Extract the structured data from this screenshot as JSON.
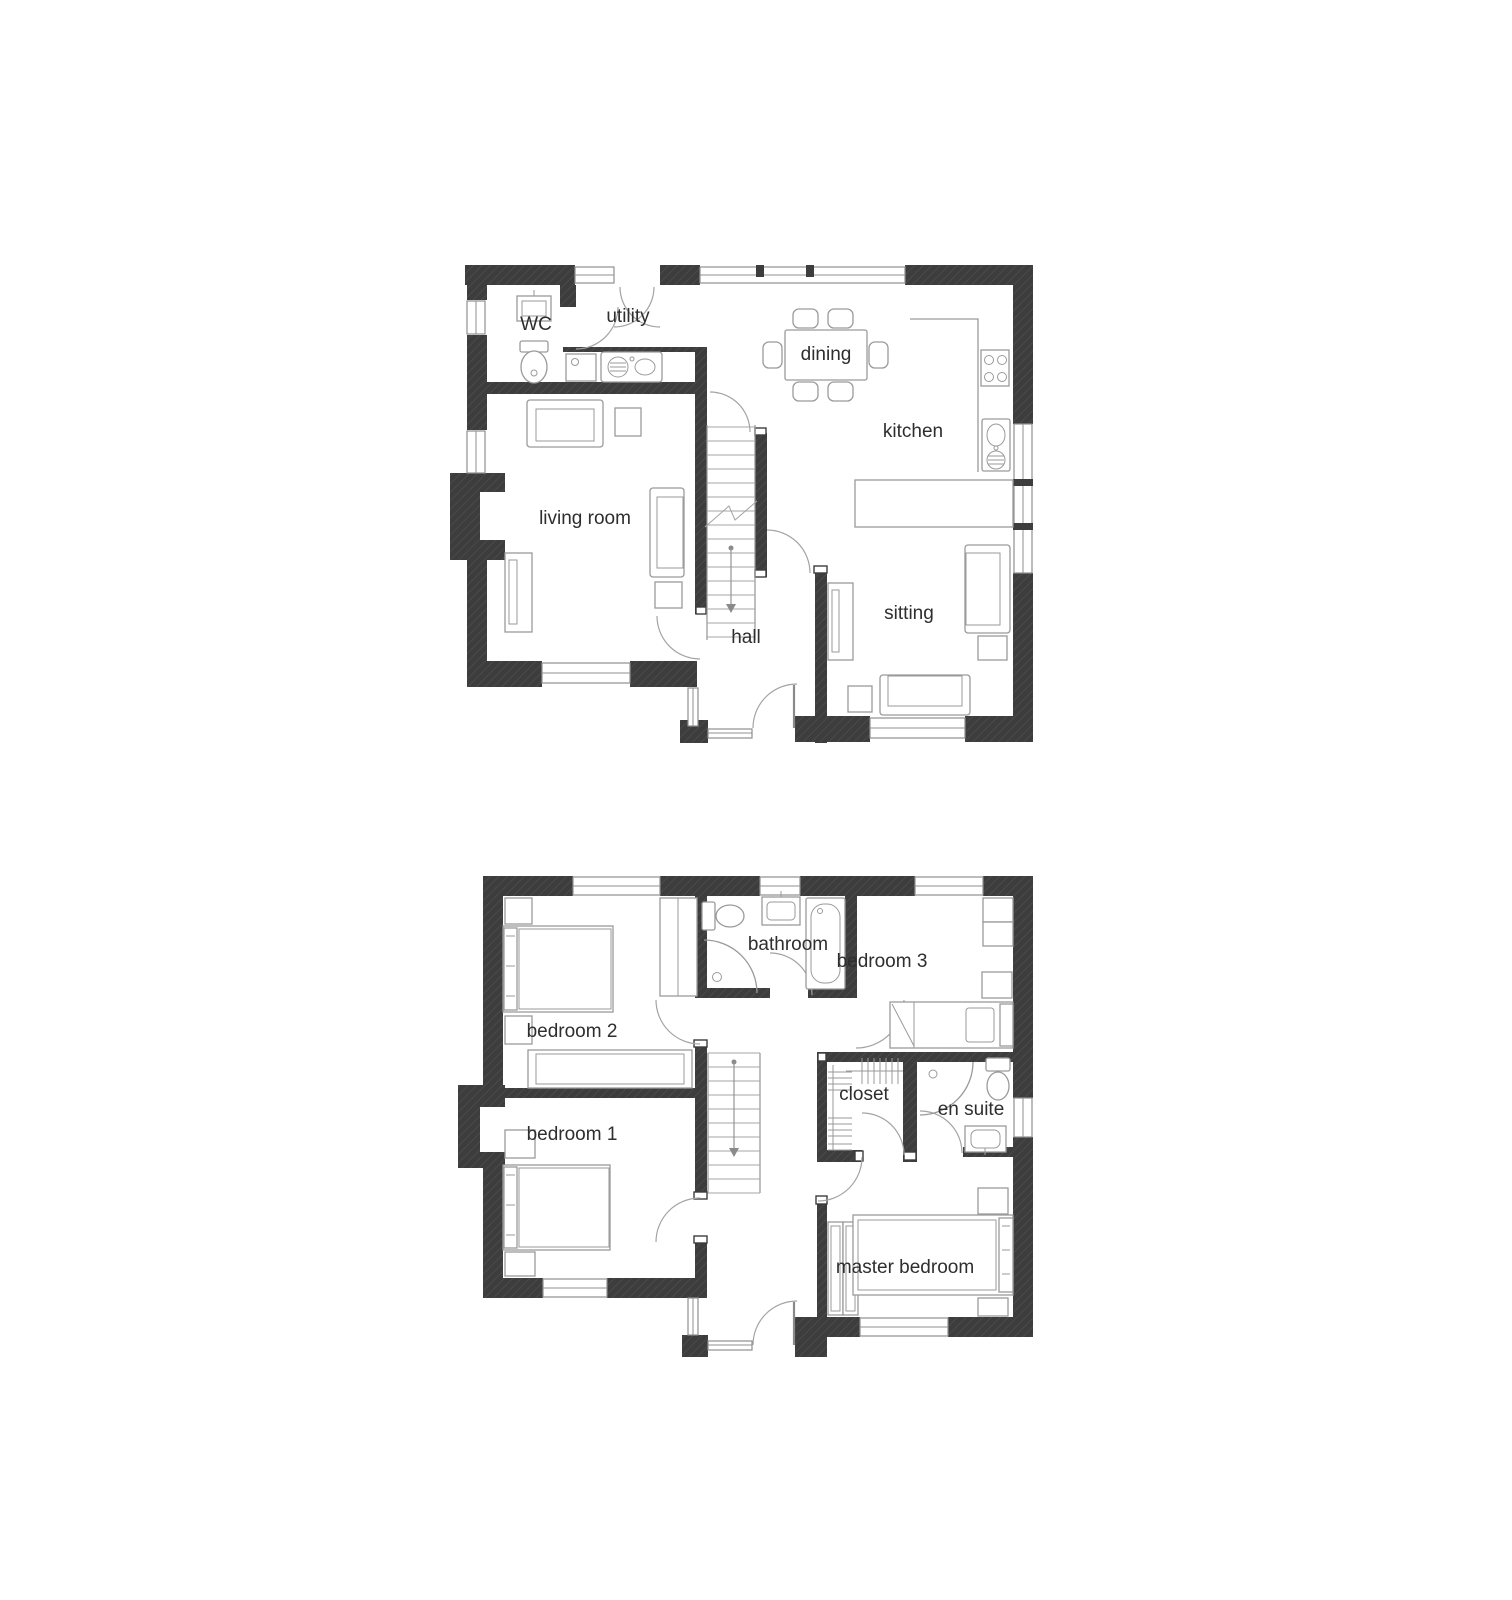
{
  "palette": {
    "wall": "#3d3d3d",
    "wall_hatch": "#4a4a4a",
    "line": "#8f8f8f",
    "furniture": "#9a9a9a",
    "door_arc": "#a3a3a3",
    "text": "#2e2e2e",
    "background": "#ffffff"
  },
  "floors": [
    {
      "id": "ground-floor",
      "rooms": [
        {
          "id": "wc",
          "label": "WC"
        },
        {
          "id": "utility",
          "label": "utility"
        },
        {
          "id": "dining",
          "label": "dining"
        },
        {
          "id": "kitchen",
          "label": "kitchen"
        },
        {
          "id": "living-room",
          "label": "living room"
        },
        {
          "id": "hall",
          "label": "hall"
        },
        {
          "id": "sitting",
          "label": "sitting"
        }
      ]
    },
    {
      "id": "first-floor",
      "rooms": [
        {
          "id": "bathroom",
          "label": "bathroom"
        },
        {
          "id": "bedroom-3",
          "label": "bedroom 3"
        },
        {
          "id": "bedroom-2",
          "label": "bedroom 2"
        },
        {
          "id": "bedroom-1",
          "label": "bedroom 1"
        },
        {
          "id": "closet",
          "label": "closet"
        },
        {
          "id": "en-suite",
          "label": "en suite"
        },
        {
          "id": "master-bedroom",
          "label": "master bedroom"
        }
      ]
    }
  ]
}
